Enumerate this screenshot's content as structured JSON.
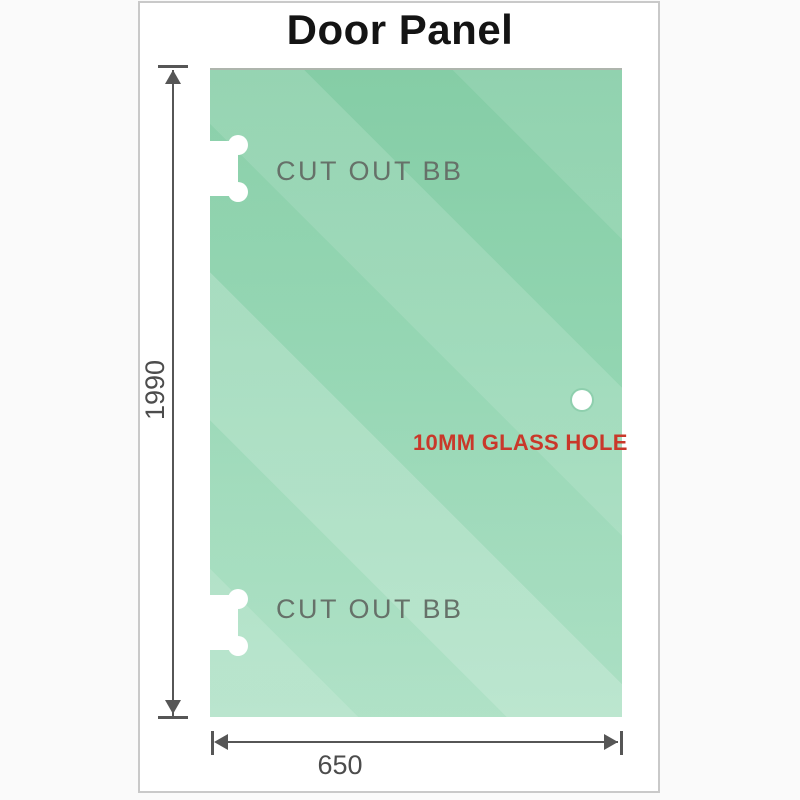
{
  "title": "Door Panel",
  "panel": {
    "cutout_top_label": "CUT OUT BB",
    "cutout_bottom_label": "CUT OUT BB",
    "hole_label": "10MM GLASS HOLE"
  },
  "dimensions": {
    "height_value": "1990",
    "width_value": "650"
  },
  "colors": {
    "glass_gradient_top": "#85cda6",
    "glass_gradient_bottom": "#a9dfc2",
    "dimension_line": "#565656",
    "hole_label_text": "#c9382a",
    "cutout_label_text": "#667169",
    "frame_border": "#c9c9c9",
    "title_text": "#141414"
  }
}
